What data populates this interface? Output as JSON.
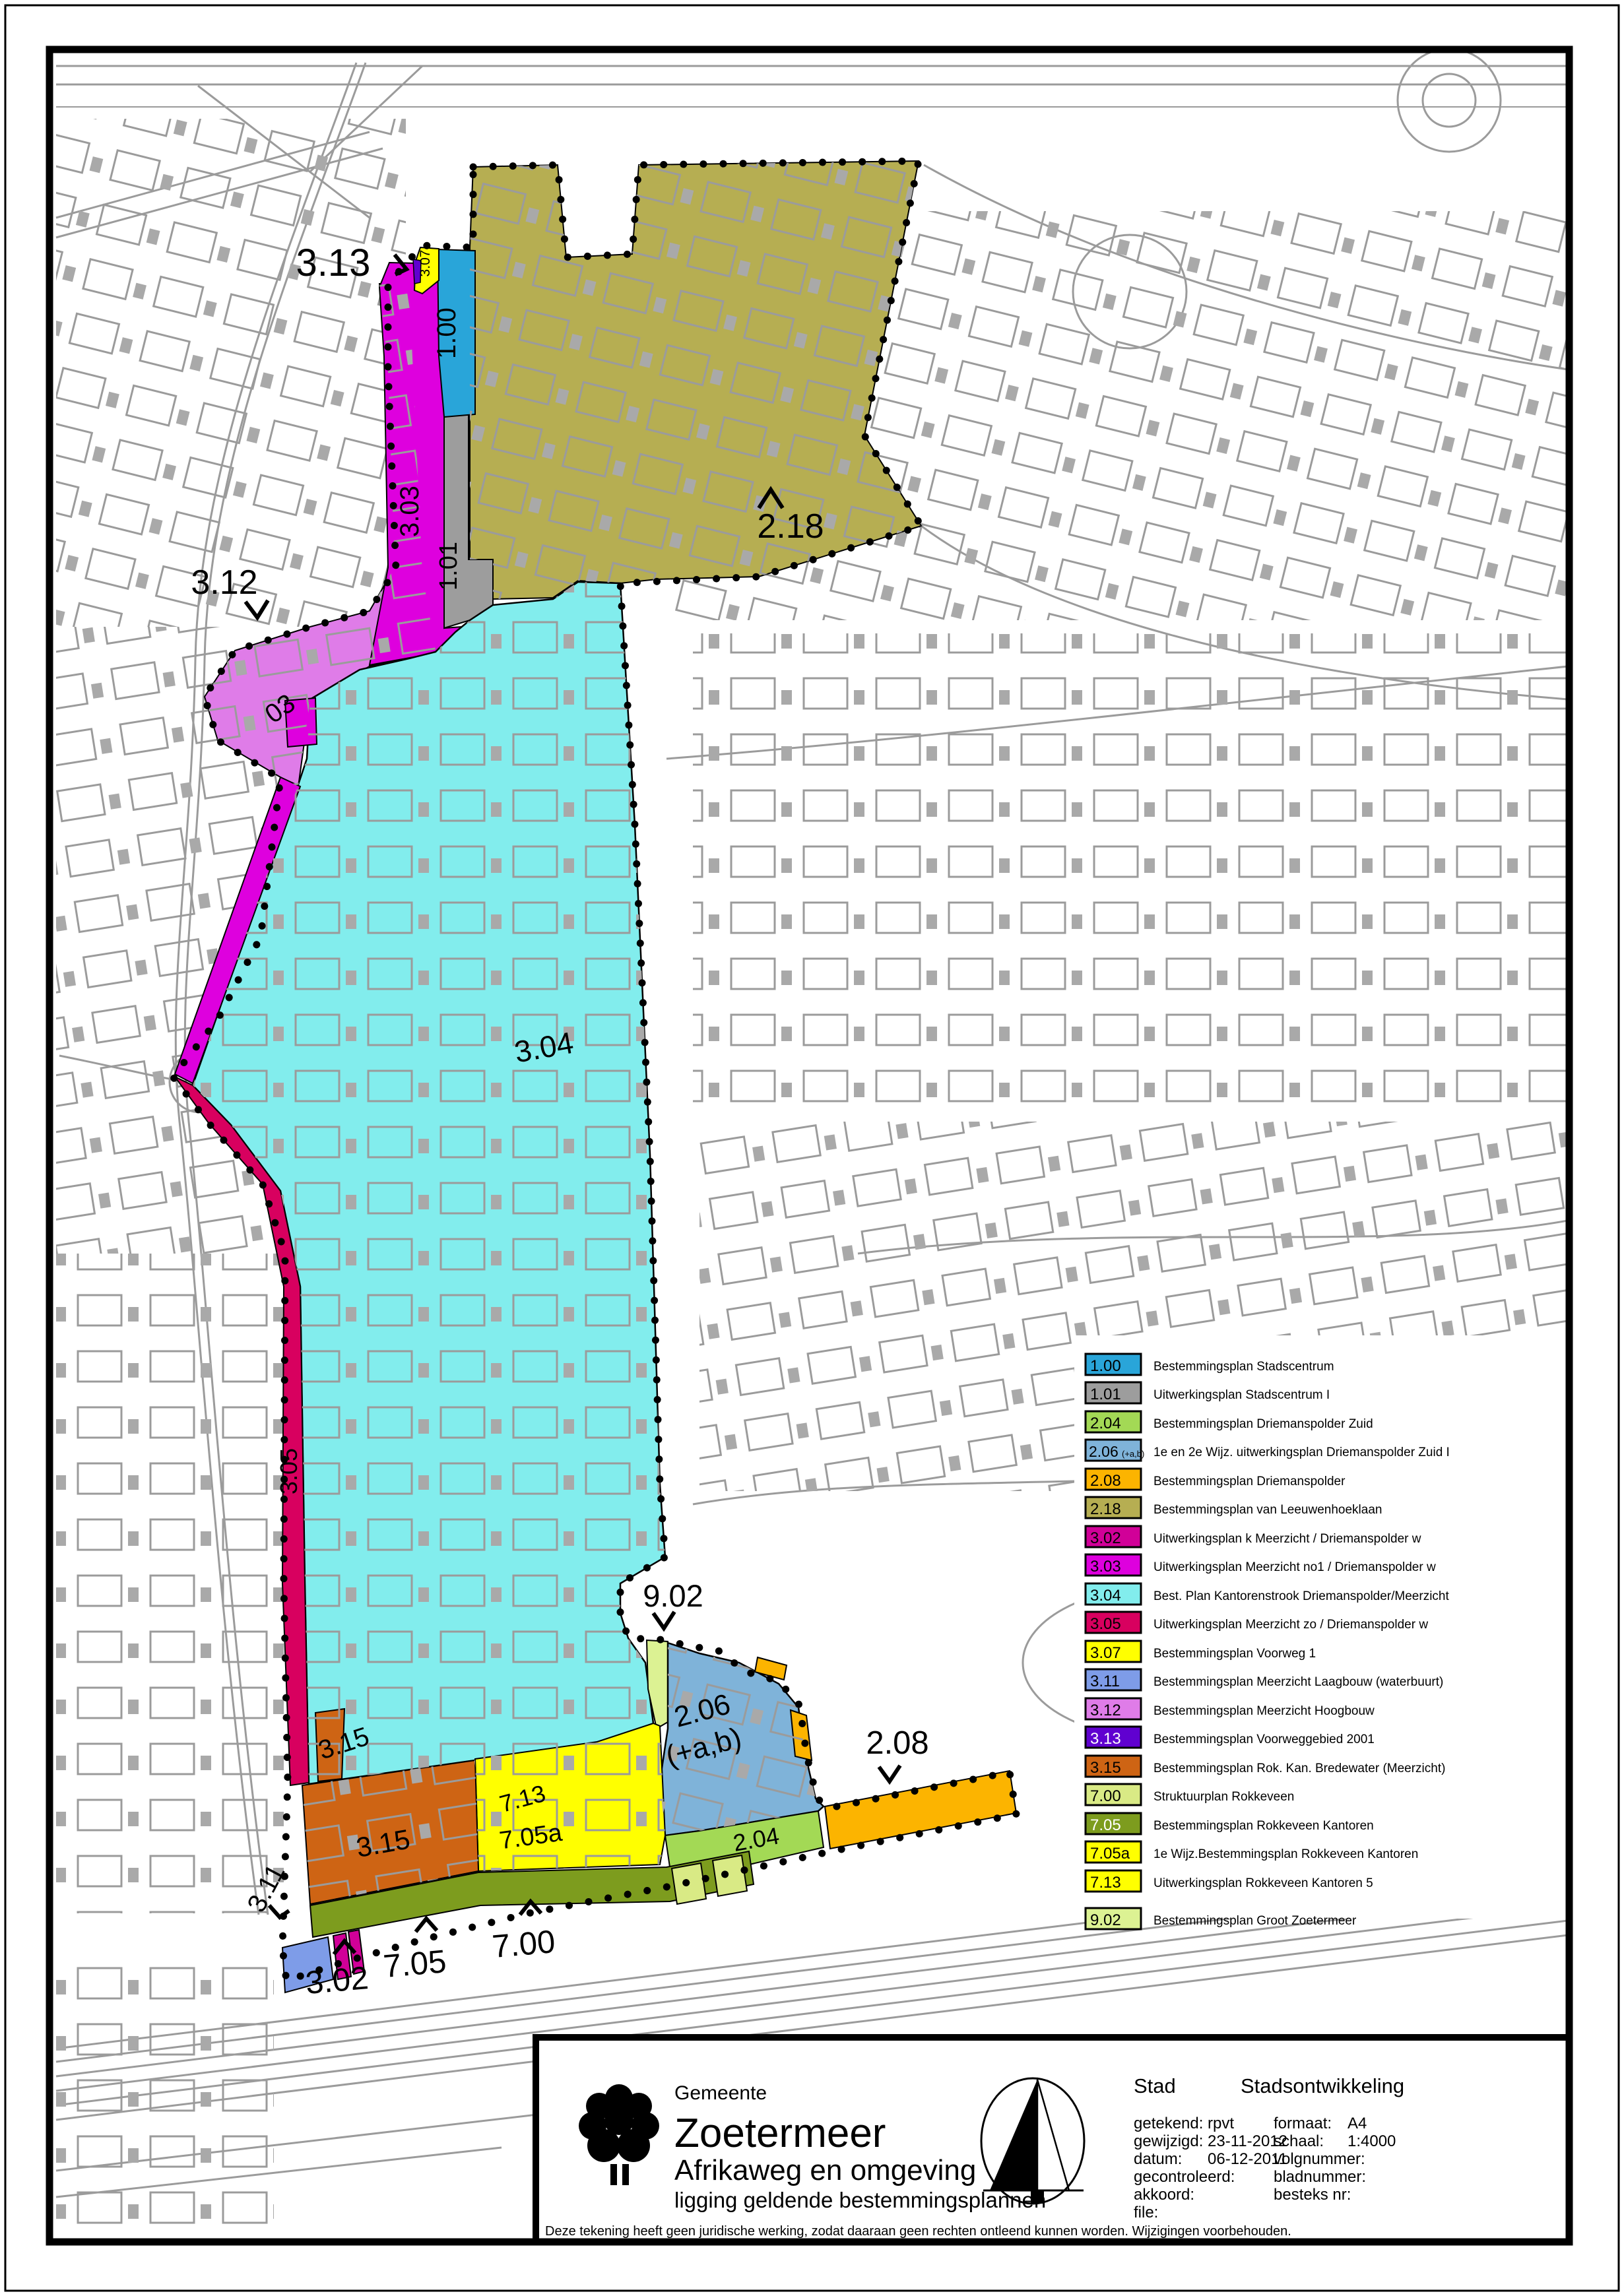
{
  "map": {
    "labels": [
      {
        "text": "3.13"
      },
      {
        "text": "3.07"
      },
      {
        "text": "1.00"
      },
      {
        "text": "3.03"
      },
      {
        "text": "1.01"
      },
      {
        "text": "2.18"
      },
      {
        "text": "3.12"
      },
      {
        "text": "03"
      },
      {
        "text": "3.04"
      },
      {
        "text": "3.05"
      },
      {
        "text": "9.02"
      },
      {
        "text": "2.06"
      },
      {
        "text": "(+a,b)"
      },
      {
        "text": "2.08"
      },
      {
        "text": "3.15"
      },
      {
        "text": "3.15"
      },
      {
        "text": "7.13"
      },
      {
        "text": "7.05a"
      },
      {
        "text": "2.04"
      },
      {
        "text": "3.11"
      },
      {
        "text": "3.02"
      },
      {
        "text": "7.05"
      },
      {
        "text": "7.00"
      }
    ]
  },
  "colors": {
    "c100": "#29a5d9",
    "c101": "#9d9d9d",
    "c204": "#a3d955",
    "c206": "#7fb3d9",
    "c208": "#fcb400",
    "c218": "#b6ae52",
    "c302": "#d10098",
    "c303": "#de00de",
    "c304": "#82eded",
    "c305": "#d8005f",
    "c307": "#ffff00",
    "c311": "#7e9ce8",
    "c312": "#df7ce8",
    "c313": "#6001d0",
    "c315": "#ce6414",
    "c700": "#d9ea85",
    "c705": "#7d9c1e",
    "c705a": "#ffff00",
    "c713": "#ffff00",
    "c902": "#dcf293"
  },
  "legend": {
    "entries": [
      {
        "code": "1.00",
        "color": "#29a5d9",
        "text_color": "#000000",
        "text": "Bestemmingsplan Stadscentrum"
      },
      {
        "code": "1.01",
        "color": "#9d9d9d",
        "text_color": "#000000",
        "text": "Uitwerkingsplan Stadscentrum I"
      },
      {
        "code": "2.04",
        "color": "#a3d955",
        "text_color": "#000000",
        "text": "Bestemmingsplan Driemanspolder Zuid"
      },
      {
        "code": "2.06",
        "suffix": "(+a,b)",
        "color": "#7fb3d9",
        "text_color": "#000000",
        "text": "1e en 2e Wijz. uitwerkingsplan Driemanspolder Zuid I"
      },
      {
        "code": "2.08",
        "color": "#fcb400",
        "text_color": "#000000",
        "text": "Bestemmingsplan Driemanspolder"
      },
      {
        "code": "2.18",
        "color": "#b6ae52",
        "text_color": "#000000",
        "text": "Bestemmingsplan van Leeuwenhoeklaan"
      },
      {
        "code": "3.02",
        "color": "#d10098",
        "text_color": "#000000",
        "text": "Uitwerkingsplan k Meerzicht / Driemanspolder w"
      },
      {
        "code": "3.03",
        "color": "#de00de",
        "text_color": "#000000",
        "text": "Uitwerkingsplan Meerzicht no1 / Driemanspolder w"
      },
      {
        "code": "3.04",
        "color": "#82eded",
        "text_color": "#000000",
        "text": "Best. Plan Kantorenstrook Driemanspolder/Meerzicht"
      },
      {
        "code": "3.05",
        "color": "#d8005f",
        "text_color": "#000000",
        "text": "Uitwerkingsplan Meerzicht zo / Driemanspolder w"
      },
      {
        "code": "3.07",
        "color": "#ffff00",
        "text_color": "#000000",
        "text": "Bestemmingsplan Voorweg 1"
      },
      {
        "code": "3.11",
        "color": "#7e9ce8",
        "text_color": "#000000",
        "text": "Bestemmingsplan Meerzicht Laagbouw (waterbuurt)"
      },
      {
        "code": "3.12",
        "color": "#df7ce8",
        "text_color": "#000000",
        "text": "Bestemmingsplan Meerzicht Hoogbouw"
      },
      {
        "code": "3.13",
        "color": "#6001d0",
        "text_color": "#ffffff",
        "text": "Bestemmingsplan Voorweggebied 2001"
      },
      {
        "code": "3.15",
        "color": "#ce6414",
        "text_color": "#000000",
        "text": "Bestemmingsplan Rok. Kan. Bredewater (Meerzicht)"
      },
      {
        "code": "7.00",
        "color": "#d9ea85",
        "text_color": "#000000",
        "text": "Struktuurplan Rokkeveen"
      },
      {
        "code": "7.05",
        "color": "#7d9c1e",
        "text_color": "#ffffff",
        "text": "Bestemmingsplan Rokkeveen Kantoren"
      },
      {
        "code": "7.05a",
        "color": "#ffff00",
        "text_color": "#000000",
        "text": "1e Wijz.Bestemmingsplan Rokkeveen Kantoren"
      },
      {
        "code": "7.13",
        "color": "#ffff00",
        "text_color": "#000000",
        "text": "Uitwerkingsplan Rokkeveen Kantoren 5"
      },
      {
        "code": "9.02",
        "color": "#dcf293",
        "text_color": "#000000",
        "text": "Bestemmingsplan Groot Zoetermeer"
      }
    ]
  },
  "title_block": {
    "gemeente_label": "Gemeente",
    "municipality": "Zoetermeer",
    "project": "Afrikaweg en omgeving",
    "subtitle": "ligging geldende bestemmingsplannen",
    "dept_left": "Stad",
    "dept_right": "Stadsontwikkeling",
    "fields_left": [
      {
        "label": "getekend:",
        "value": "rpvt"
      },
      {
        "label": "gewijzigd:",
        "value": "23-11-2012"
      },
      {
        "label": "datum:",
        "value": "06-12-2011"
      },
      {
        "label": "gecontroleerd:",
        "value": ""
      },
      {
        "label": "akkoord:",
        "value": ""
      },
      {
        "label": "file:",
        "value": ""
      }
    ],
    "fields_right": [
      {
        "label": "formaat:",
        "value": "A4"
      },
      {
        "label": "schaal:",
        "value": "1:4000"
      },
      {
        "label": "volgnummer:",
        "value": ""
      },
      {
        "label": "bladnummer:",
        "value": ""
      },
      {
        "label": "besteks nr:",
        "value": ""
      }
    ],
    "disclaimer": "Deze tekening heeft geen juridische werking, zodat daaraan geen rechten ontleend kunnen worden. Wijzigingen voorbehouden."
  }
}
